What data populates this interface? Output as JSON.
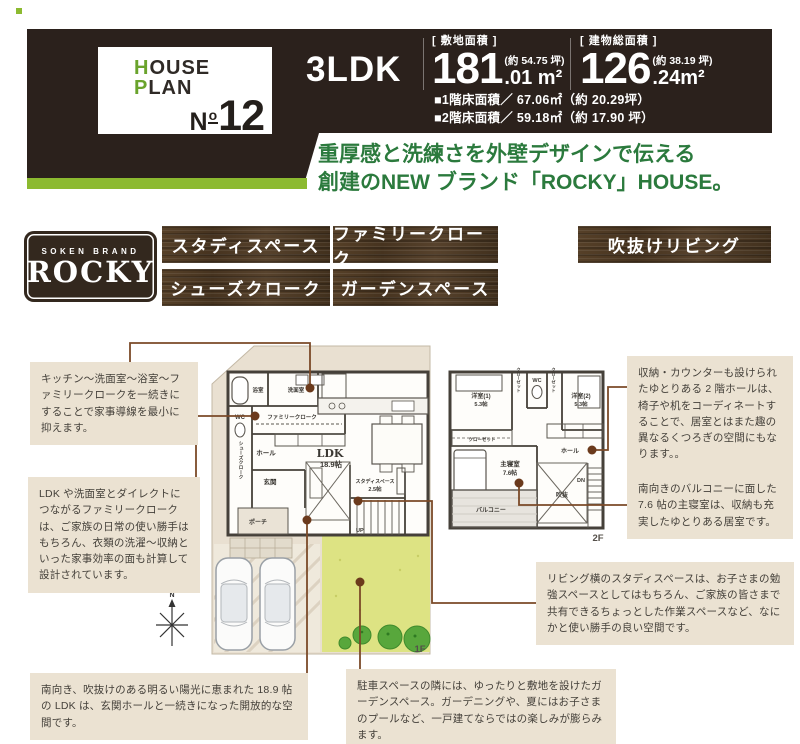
{
  "colors": {
    "header_brown": "#2b211c",
    "accent_green": "#8cba30",
    "headline_green": "#2b7a3d",
    "tag_wood_brown": "#4c3826",
    "callout_bg": "#ebe2d2",
    "connector_brown": "#7b4a28",
    "garden_green": "#dde383"
  },
  "header": {
    "card": {
      "h_first": "H",
      "h_rest": "OUSE",
      "p_first": "P",
      "p_rest": "LAN",
      "no_n": "N",
      "no_o": "o",
      "no_num": "12"
    },
    "ldk": "3LDK",
    "lot": {
      "label": "[ 敷地面積 ]",
      "int": "181",
      "dec": ".01 m²",
      "approx": "(約 54.75 坪)"
    },
    "building": {
      "label": "[ 建物総面積 ]",
      "int": "126",
      "dec": ".24m²",
      "approx": "(約 38.19 坪)"
    },
    "floor1": "■1階床面積／ 67.06㎡（約 20.29坪）",
    "floor2": "■2階床面積／ 59.18㎡（約 17.90 坪）"
  },
  "headline": {
    "line1": "重厚感と洗練さを外壁デザインで伝える",
    "line2": "創建のNEW ブランド「ROCKY」HOUSE。"
  },
  "brand": {
    "small": "SOKEN BRAND",
    "name": "ROCKY"
  },
  "features": [
    "スタディスペース",
    "ファミリークローク",
    "吹抜けリビング",
    "シューズクローク",
    "ガーデンスペース"
  ],
  "callouts": [
    "キッチン～洗面室～浴室～ファミリークロークを一続きにすることで家事導線を最小に抑えます。",
    "LDK や洗面室とダイレクトにつながるファミリークロークは、ご家族の日常の使い勝手はもちろん、衣類の洗濯～収納といった家事効率の面も計算して設計されています。",
    "南向き、吹抜けのある明るい陽光に恵まれた 18.9 帖の LDK は、玄関ホールと一続きになった開放的な空間です。",
    "収納・カウンターも設けられたゆとりある 2 階ホールは、椅子や机をコーディネートすることで、居室とはまた趣の異なるくつろぎの空間にもなります。。",
    "南向きのバルコニーに面した 7.6 帖の主寝室は、収納も充実したゆとりある居室です。",
    "リビング横のスタディスペースは、お子さまの勉強スペースとしてはもちろん、ご家族の皆さまで共有できるちょっとした作業スペースなど、なにかと使い勝手の良い空間です。",
    "駐車スペースの隣には、ゆったりと敷地を設けたガーデンスペース。ガーデニングや、夏にはお子さまのプールなど、一戸建てならではの楽しみが膨らみます。"
  ],
  "plans": {
    "f1": {
      "label": "1F",
      "bath": "浴室",
      "wash": "洗面室",
      "wc": "WC",
      "family_cloak": "ファミリークローク",
      "hall": "ホール",
      "genkan": "玄関",
      "porch": "ポーチ",
      "shoes": "シューズクローク",
      "ldk": "LDK",
      "ldk_size": "18.9帖",
      "study": "スタディスペース",
      "study_size": "2.5帖",
      "up": "UP"
    },
    "f2": {
      "label": "2F",
      "room1": "洋室(1)",
      "room1_size": "5.3帖",
      "room2": "洋室(2)",
      "room2_size": "5.3帖",
      "wc": "WC",
      "closet": "クローゼット",
      "master": "主寝室",
      "master_size": "7.6帖",
      "hall": "ホール",
      "void": "吹抜",
      "balcony": "バルコニー",
      "dn": "DN"
    },
    "compass": "N"
  }
}
